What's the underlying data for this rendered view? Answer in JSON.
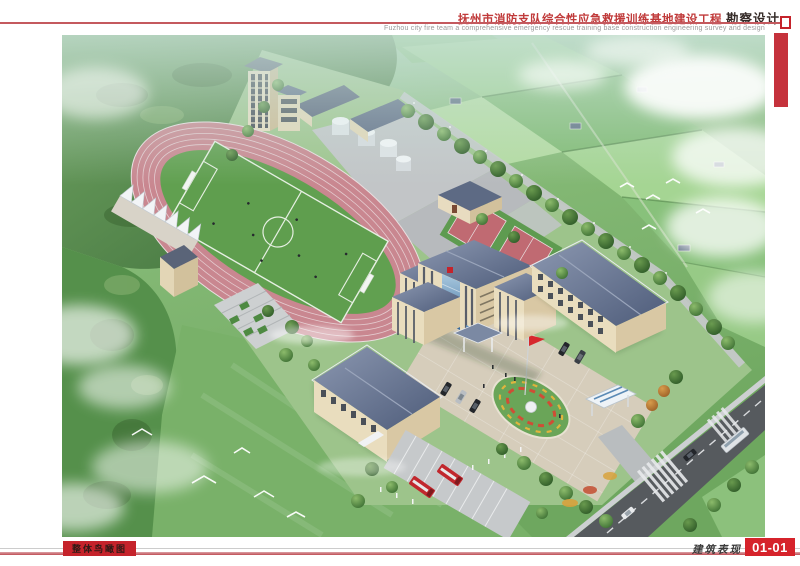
{
  "header": {
    "project_title_cn": "抚州市消防支队综合性应急救援训练基地建设工程",
    "title_suffix_cn": "勘察设计",
    "subtitle_en": "Fuzhou city fire team a comprehensive emergency rescue training base construction engineering survey and design"
  },
  "footer": {
    "view_label_cn": "整体鸟瞰图",
    "category_cn": "建筑表现",
    "sheet_number": "01-01"
  },
  "colors": {
    "accent_red": "#c5232b",
    "rule_red": "#c4595e",
    "sheet_number_bg": "#d6232b",
    "track_pink": "#c98790",
    "pitch_green": "#5f9e4e",
    "roof_slate": "#5d6b88",
    "wall_cream": "#e9ddbe",
    "glass_blue": "#4d7fae",
    "fire_truck_red": "#c1272d",
    "flag_red": "#d7282d",
    "road_dark": "#565a5e"
  }
}
